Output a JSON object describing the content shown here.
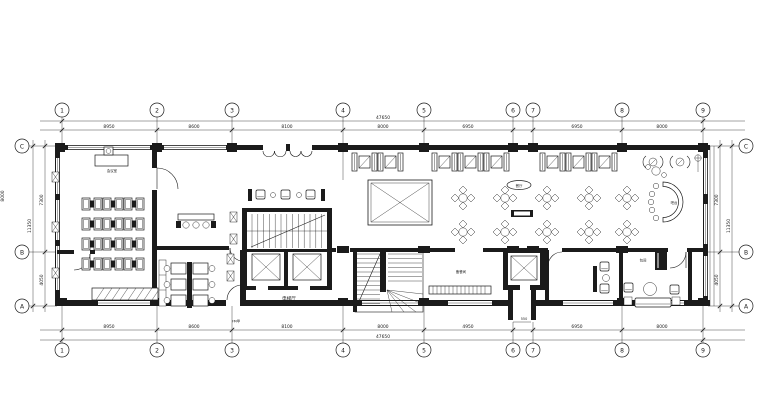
{
  "grid": {
    "columns": [
      "1",
      "2",
      "3",
      "4",
      "5",
      "6",
      "7",
      "8",
      "9"
    ],
    "rows": [
      "C",
      "B",
      "A"
    ]
  },
  "dims": {
    "top": {
      "overall": "47650",
      "segs": [
        "8950",
        "8600",
        "8100",
        "8000",
        "6950",
        "",
        "6950",
        "8000"
      ]
    },
    "bottom": {
      "overall": "47650",
      "segs": [
        "8950",
        "8600",
        "8100",
        "8000",
        "4950",
        "",
        "6950",
        "8000"
      ]
    },
    "left": {
      "overall": "11350",
      "upper": "7300",
      "lower": "4050",
      "edge": "8000"
    },
    "right": {
      "overall": "11350",
      "upper": "7300",
      "lower": "4050"
    }
  },
  "labels": {
    "elevator_hall": "电梯厅",
    "meeting_room": "会议室",
    "pantry": "备餐间",
    "dining": "餐厅",
    "bar": "吧台",
    "private_room": "包间",
    "door_tag": "FM甲",
    "shaft_dim": "550"
  }
}
